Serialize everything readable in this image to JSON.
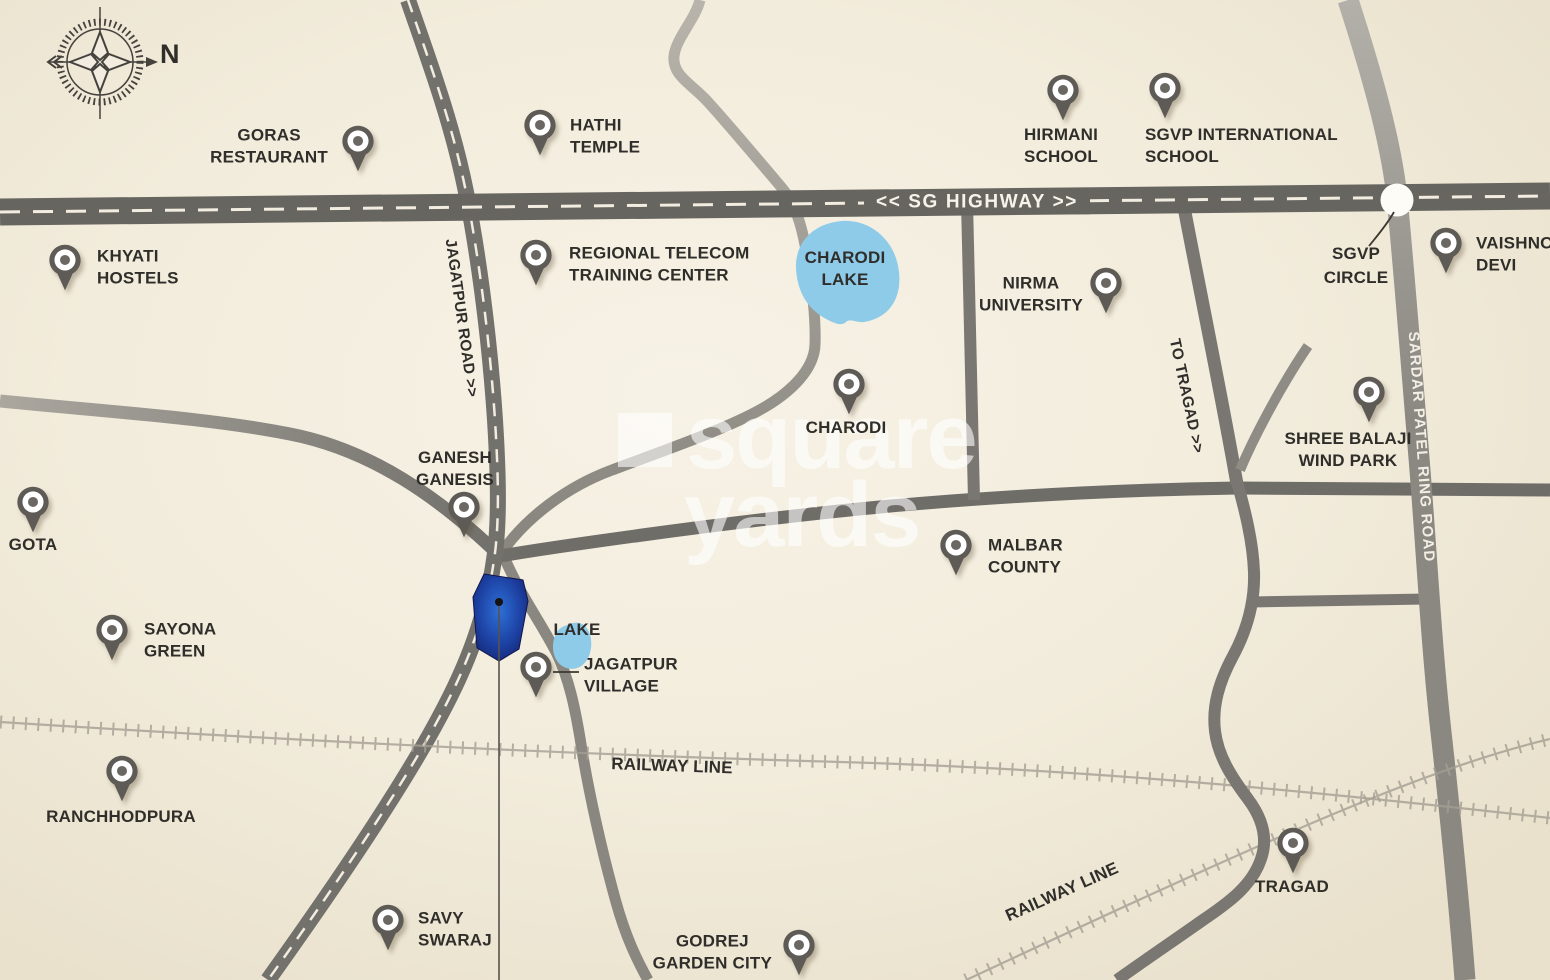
{
  "map": {
    "compass_north": "N",
    "watermark": {
      "line1": "square",
      "line2": "yards"
    },
    "road_labels": {
      "sg_highway": "<< SG HIGHWAY >>",
      "jagatpur_road": "JAGATPUR ROAD >>",
      "to_tragad": "TO TRAGAD >>",
      "sardar_patel_ring_road": "SARDAR PATEL RING ROAD",
      "railway_line_west": "RAILWAY LINE",
      "railway_line_southeast": "RAILWAY LINE"
    },
    "area_labels": {
      "charodi_lake_line1": "CHARODI",
      "charodi_lake_line2": "LAKE",
      "small_lake": "LAKE",
      "sgvp_circle_line1": "SGVP",
      "sgvp_circle_line2": "CIRCLE"
    },
    "colors": {
      "background": "#f2ecdc",
      "road_dark": "#6f6d68",
      "highway": "#67655f",
      "lake_blue": "#8ecbe9",
      "plot_blue": "#1d3d9e",
      "pin_gray": "#5e5b56"
    },
    "markers": [
      {
        "id": "goras-restaurant",
        "lines": [
          "GORAS",
          "RESTAURANT"
        ],
        "x": 358,
        "y": 141,
        "lx": 328,
        "ly": 146,
        "placement": "left",
        "align": "center"
      },
      {
        "id": "hathi-temple",
        "lines": [
          "HATHI",
          "TEMPLE"
        ],
        "x": 540,
        "y": 125,
        "lx": 570,
        "ly": 136,
        "placement": "right",
        "align": "left"
      },
      {
        "id": "hirmani-school",
        "lines": [
          "HIRMANI",
          "SCHOOL"
        ],
        "x": 1063,
        "y": 90,
        "lx": 1061,
        "ly": 124,
        "placement": "below",
        "align": "center"
      },
      {
        "id": "sgvp-international-school",
        "lines": [
          "SGVP INTERNATIONAL",
          "SCHOOL"
        ],
        "x": 1165,
        "y": 88,
        "lx": 1145,
        "ly": 124,
        "placement": "below-left",
        "align": "left"
      },
      {
        "id": "khyati-hostels",
        "lines": [
          "KHYATI",
          "HOSTELS"
        ],
        "x": 65,
        "y": 260,
        "lx": 97,
        "ly": 267,
        "placement": "right",
        "align": "left"
      },
      {
        "id": "regional-telecom-training-center",
        "lines": [
          "REGIONAL TELECOM",
          "TRAINING CENTER"
        ],
        "x": 536,
        "y": 255,
        "lx": 569,
        "ly": 264,
        "placement": "right",
        "align": "left"
      },
      {
        "id": "nirma-university",
        "lines": [
          "NIRMA",
          "UNIVERSITY"
        ],
        "x": 1106,
        "y": 283,
        "lx": 1083,
        "ly": 294,
        "placement": "left",
        "align": "center"
      },
      {
        "id": "vaishno-devi",
        "lines": [
          "VAISHNO",
          "DEVI"
        ],
        "x": 1446,
        "y": 243,
        "lx": 1476,
        "ly": 254,
        "placement": "right",
        "align": "left"
      },
      {
        "id": "charodi",
        "lines": [
          "CHARODI"
        ],
        "x": 849,
        "y": 384,
        "lx": 846,
        "ly": 417,
        "placement": "below",
        "align": "center"
      },
      {
        "id": "shree-balaji-wind-park",
        "lines": [
          "SHREE BALAJI",
          "WIND PARK"
        ],
        "x": 1369,
        "y": 392,
        "lx": 1348,
        "ly": 428,
        "placement": "below",
        "align": "center"
      },
      {
        "id": "ganesh-ganesis",
        "lines": [
          "GANESH",
          "GANESIS"
        ],
        "x": 464,
        "y": 507,
        "lx": 455,
        "ly": 490,
        "placement": "above",
        "align": "center"
      },
      {
        "id": "gota",
        "lines": [
          "GOTA"
        ],
        "x": 33,
        "y": 502,
        "lx": 33,
        "ly": 534,
        "placement": "below",
        "align": "center"
      },
      {
        "id": "malbar-county",
        "lines": [
          "MALBAR",
          "COUNTY"
        ],
        "x": 956,
        "y": 545,
        "lx": 988,
        "ly": 556,
        "placement": "right",
        "align": "left"
      },
      {
        "id": "sayona-green",
        "lines": [
          "SAYONA",
          "GREEN"
        ],
        "x": 112,
        "y": 630,
        "lx": 144,
        "ly": 640,
        "placement": "right",
        "align": "left"
      },
      {
        "id": "jagatpur-village",
        "lines": [
          "JAGATPUR",
          "VILLAGE"
        ],
        "x": 536,
        "y": 667,
        "lx": 584,
        "ly": 675,
        "placement": "right",
        "align": "left"
      },
      {
        "id": "ranchhodpura",
        "lines": [
          "RANCHHODPURA"
        ],
        "x": 122,
        "y": 771,
        "lx": 121,
        "ly": 806,
        "placement": "below",
        "align": "center"
      },
      {
        "id": "savy-swaraj",
        "lines": [
          "SAVY",
          "SWARAJ"
        ],
        "x": 388,
        "y": 920,
        "lx": 418,
        "ly": 929,
        "placement": "right",
        "align": "left"
      },
      {
        "id": "godrej-garden-city",
        "lines": [
          "GODREJ",
          "GARDEN CITY"
        ],
        "x": 799,
        "y": 945,
        "lx": 772,
        "ly": 952,
        "placement": "left",
        "align": "center"
      },
      {
        "id": "tragad",
        "lines": [
          "TRAGAD"
        ],
        "x": 1293,
        "y": 843,
        "lx": 1292,
        "ly": 876,
        "placement": "below",
        "align": "center"
      }
    ]
  }
}
